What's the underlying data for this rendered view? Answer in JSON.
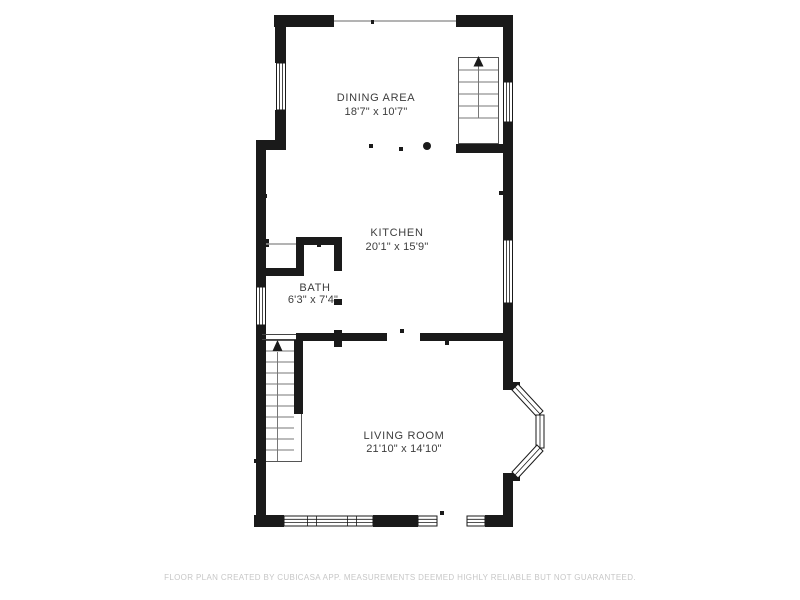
{
  "floor_plan": {
    "rooms": {
      "dining_area": {
        "name": "DINING AREA",
        "dimensions": "18'7\" x 10'7\""
      },
      "kitchen": {
        "name": "KITCHEN",
        "dimensions": "20'1\" x 15'9\""
      },
      "bath": {
        "name": "BATH",
        "dimensions": "6'3\" x 7'4\""
      },
      "living_room": {
        "name": "LIVING ROOM",
        "dimensions": "21'10\" x 14'10\""
      }
    },
    "footer_disclaimer": "FLOOR PLAN CREATED BY CUBICASA APP. MEASUREMENTS DEEMED HIGHLY RELIABLE BUT NOT GUARANTEED.",
    "colors": {
      "wall": "#1a1a1a",
      "background": "#ffffff",
      "footer_text": "#c7c7c7",
      "window_frame": "#1a1a1a"
    },
    "icons": {
      "stair_direction": "stairs-up-arrow"
    }
  }
}
